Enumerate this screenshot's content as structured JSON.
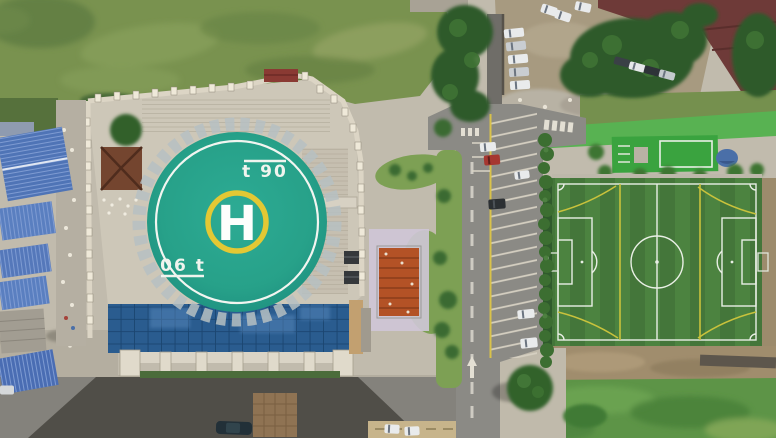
{
  "scene": {
    "type": "aerial-photograph",
    "title": "Drone top-down view of a rooftop helipad beside a soccer field"
  },
  "helipad": {
    "center_letter": "H",
    "marking_top_right": "t 90",
    "marking_bottom_left": "06 t",
    "colors": {
      "pad": "#28a38a",
      "inner_ring": "#f2f5f0",
      "h_ring": "#e3c834",
      "letter": "#fdfefc"
    }
  },
  "soccer_field": {
    "colors": {
      "turf": "#48803d",
      "lines": "#e9efe5",
      "secondary_lines": "#c9c23c"
    },
    "markings": [
      "boundary",
      "halfway line",
      "center circle",
      "penalty areas",
      "goal areas",
      "penalty arcs",
      "corner arcs",
      "yellow overlay pitch lines"
    ]
  },
  "street": {
    "angled_parking_bays": true,
    "lane_line_color": "#d9c24a",
    "cars_visible": 23
  },
  "regions": [
    "weedy grass field",
    "tree clusters",
    "gravel lot with rubble",
    "dark-red roof building",
    "green rooftop band",
    "green canopy structure",
    "walled helipad courtyard with steps",
    "brown pavilion roof",
    "orange shrine roof under scaffold",
    "blue glass curtain-wall building",
    "blue warehouse roofs",
    "street with angled parking",
    "artificial turf soccer pitch",
    "dirt strip and scrub"
  ]
}
